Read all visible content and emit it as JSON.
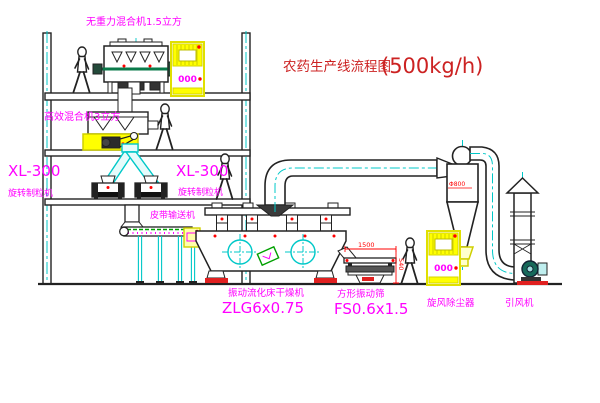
{
  "title": {
    "text_cn": "农药生产线流程图",
    "capacity": "(500kg/h)"
  },
  "colors": {
    "label_magenta": "#ff00ff",
    "title_red": "#cc2222",
    "accent_red": "#ff0000",
    "centerline_cyan": "#00c8c8",
    "highlight_yellow": "#ffff00",
    "conveyor_green": "#00a000",
    "ink": "#222222"
  },
  "labels": {
    "top_mixer": "无重力混合机1.5立方",
    "mixer2": "高效混合机3立方",
    "granulator_left_model": "XL-300",
    "granulator_left_name": "旋转制粒机",
    "granulator_mid_model": "XL-300",
    "granulator_mid_name": "旋转制粒机",
    "belt_conveyor": "皮带输送机",
    "dryer_name": "振动流化床干燥机",
    "dryer_model": "ZLG6x0.75",
    "sieve_name": "方形振动筛",
    "sieve_model": "FS0.6x1.5",
    "cyclone_name": "旋风除尘器",
    "fan_name": "引风机"
  },
  "annotations": {
    "cabinet_display": "000",
    "cyclone_diameter": "Φ800",
    "dim_horizontal": "1500",
    "dim_vertical": "540"
  }
}
